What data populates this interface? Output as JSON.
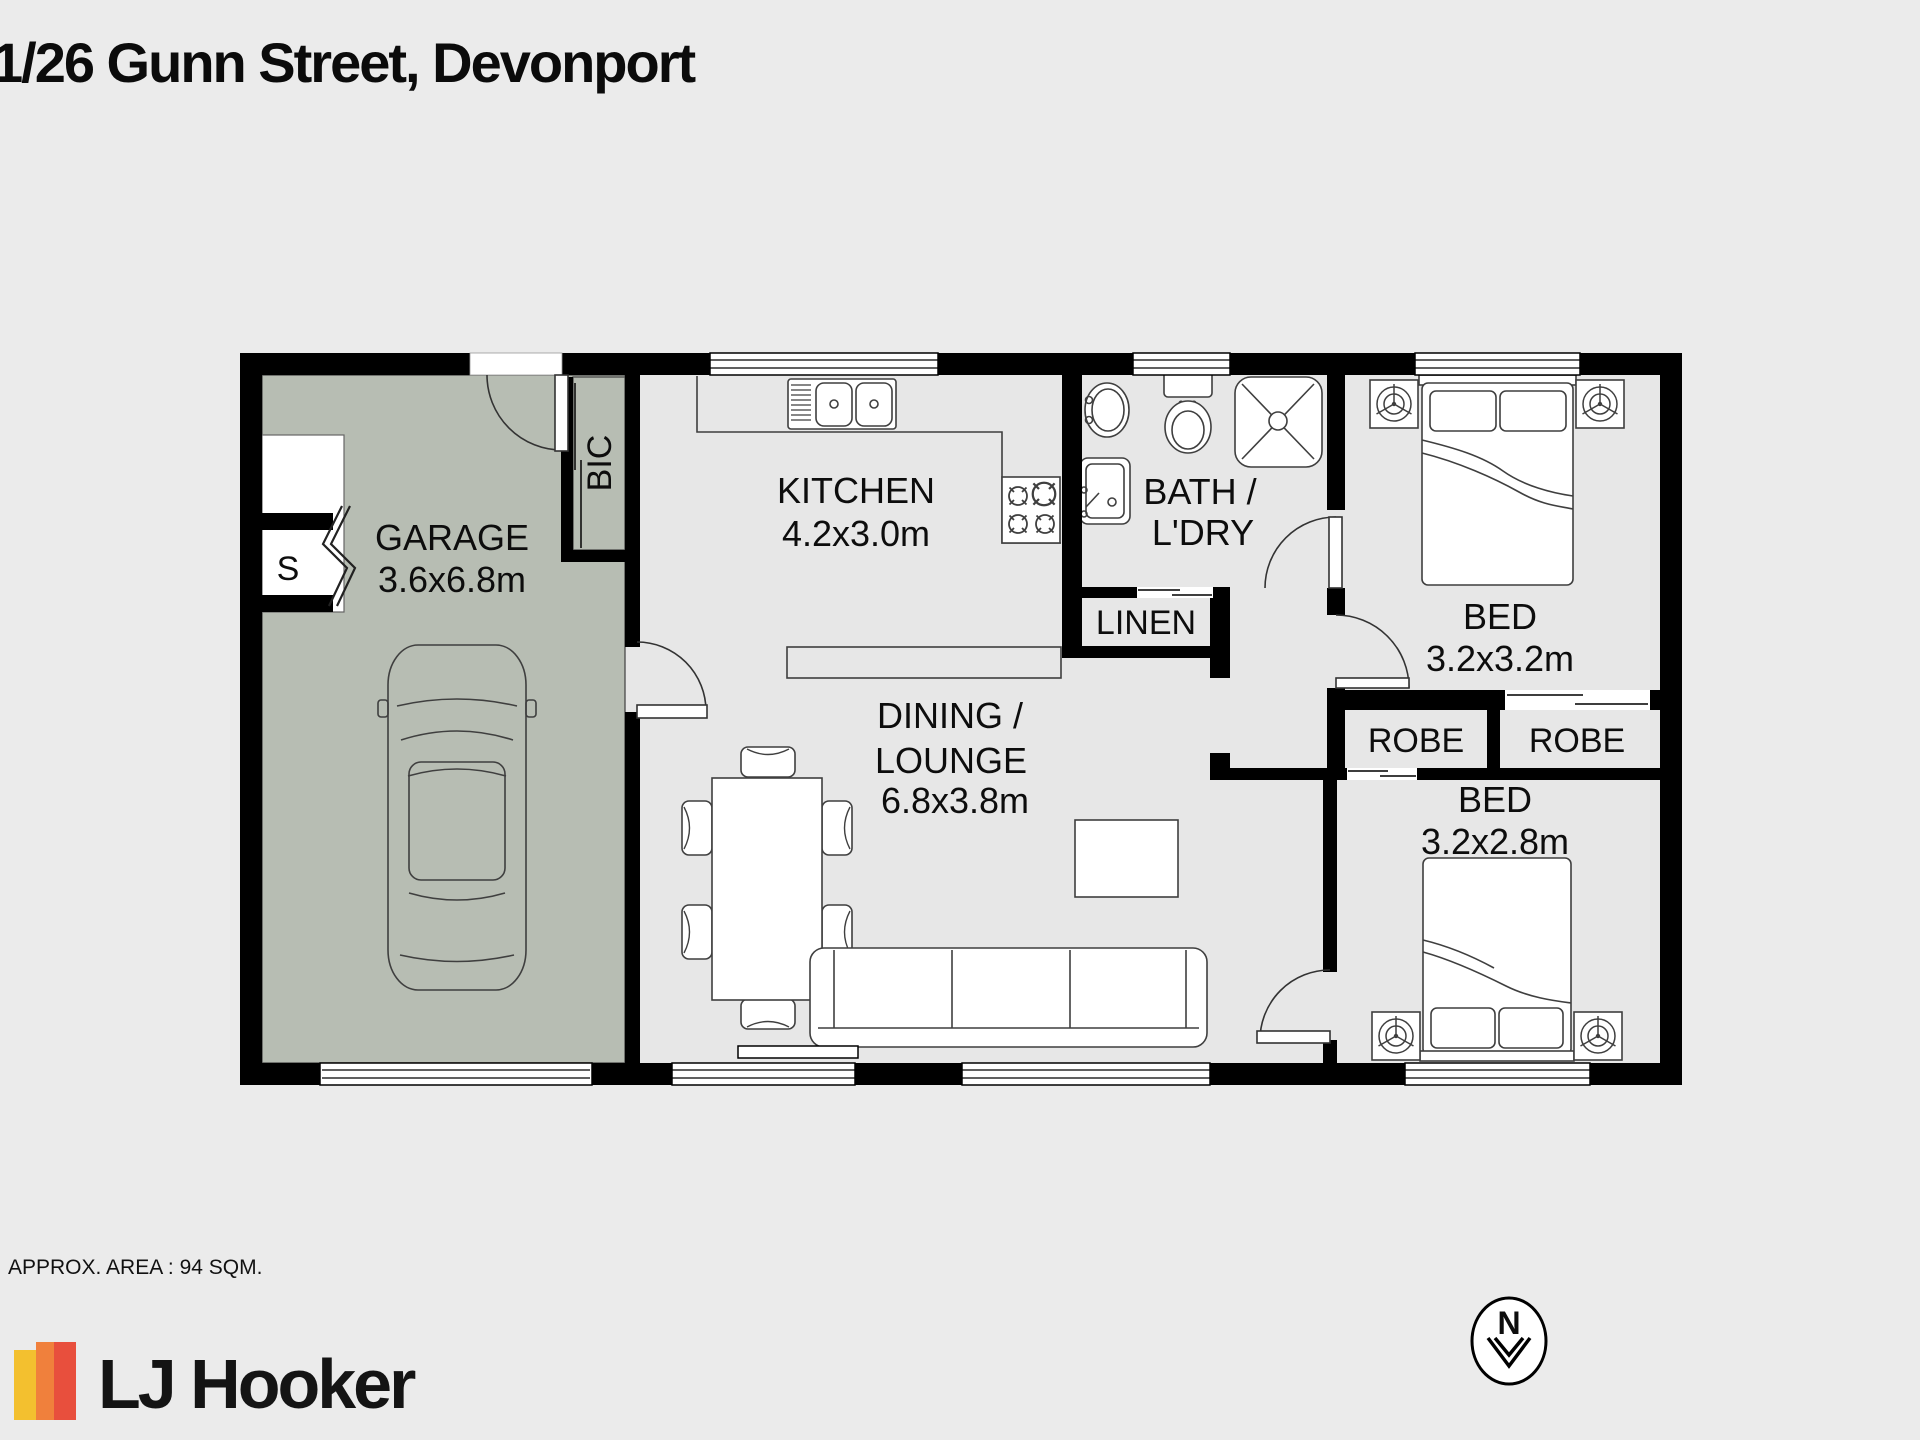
{
  "title": "1/26 Gunn Street, Devonport",
  "footer": {
    "area_text": "APPROX. AREA : 94 SQM."
  },
  "logo": {
    "text": "LJ Hooker",
    "stripe_colors": [
      "#f3c02f",
      "#f0803c",
      "#e84f3d"
    ]
  },
  "north": {
    "label": "N"
  },
  "colors": {
    "background": "#ebebeb",
    "wall": "#000000",
    "garage_fill": "#b7bdb3",
    "floor_fill": "#e7e7e7",
    "furniture_stroke": "#3f3f3f"
  },
  "rooms": {
    "garage": {
      "label": "GARAGE",
      "dims": "3.6x6.8m"
    },
    "storage": {
      "label": "S"
    },
    "bic": {
      "label": "BIC"
    },
    "kitchen": {
      "label": "KITCHEN",
      "dims": "4.2x3.0m"
    },
    "bath": {
      "line1": "BATH /",
      "line2": "L'DRY"
    },
    "linen": {
      "label": "LINEN"
    },
    "bed1": {
      "label": "BED",
      "dims": "3.2x3.2m"
    },
    "robe1": {
      "label": "ROBE"
    },
    "robe2": {
      "label": "ROBE"
    },
    "bed2": {
      "label": "BED",
      "dims": "3.2x2.8m"
    },
    "dining": {
      "line1": "DINING /",
      "line2": "LOUNGE",
      "dims": "6.8x3.8m"
    }
  }
}
